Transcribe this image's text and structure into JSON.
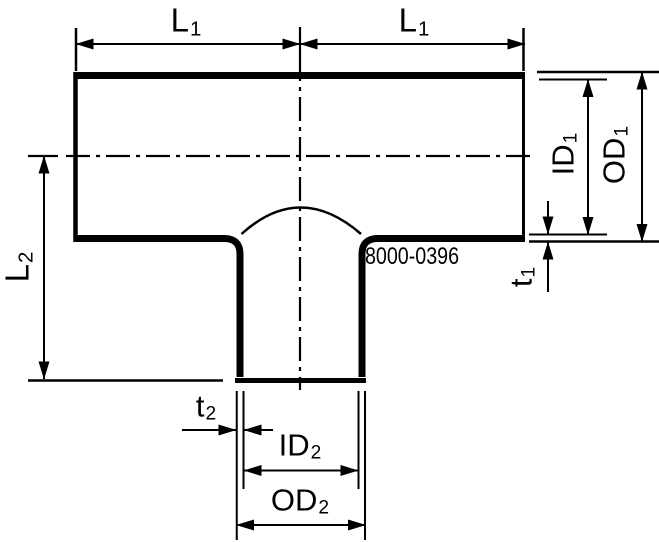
{
  "part_number": "8000-0396",
  "colors": {
    "line": "#000000",
    "background": "#ffffff"
  },
  "labels": {
    "l1_left": {
      "main": "L",
      "sub": "1"
    },
    "l1_right": {
      "main": "L",
      "sub": "1"
    },
    "l2": {
      "main": "L",
      "sub": "2"
    },
    "id1": {
      "main": "ID",
      "sub": "1"
    },
    "od1": {
      "main": "OD",
      "sub": "1"
    },
    "t1": {
      "main": "t",
      "sub": "1"
    },
    "t2": {
      "main": "t",
      "sub": "2"
    },
    "id2": {
      "main": "ID",
      "sub": "2"
    },
    "od2": {
      "main": "OD",
      "sub": "2"
    }
  }
}
